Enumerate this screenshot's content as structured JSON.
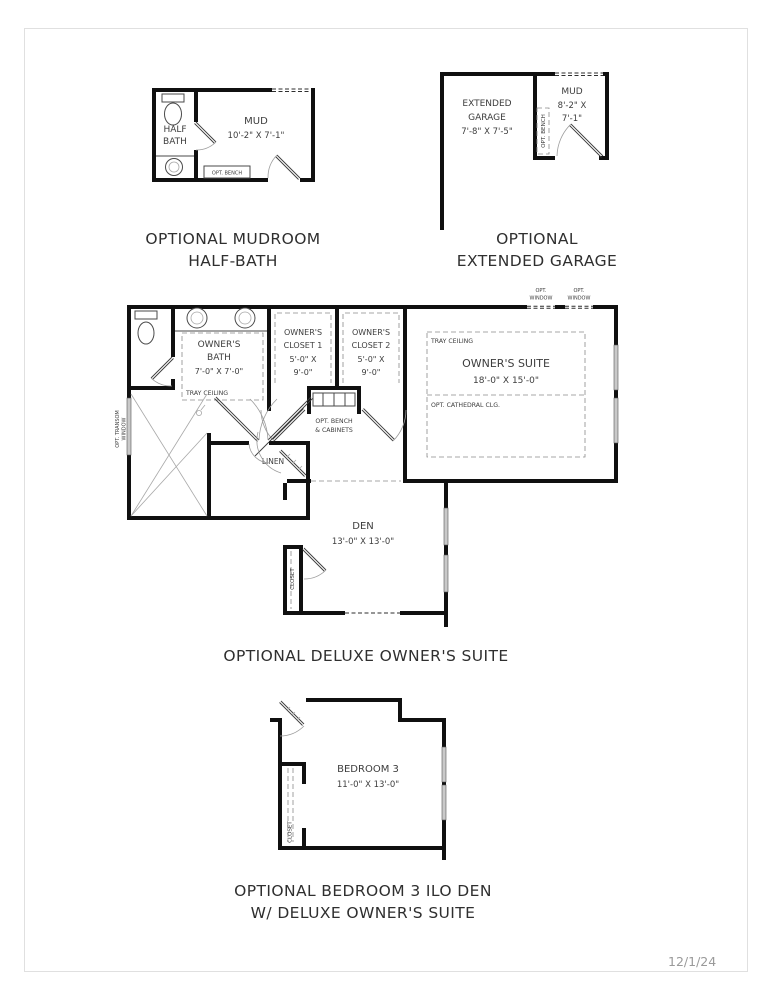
{
  "page": {
    "date": "12/1/24"
  },
  "mudroom_plan": {
    "caption_line1": "OPTIONAL MUDROOM",
    "caption_line2": "HALF-BATH",
    "half_bath_line1": "HALF",
    "half_bath_line2": "BATH",
    "mud_name": "MUD",
    "mud_dims": "10'-2\" X 7'-1\"",
    "bench_label": "OPT. BENCH"
  },
  "garage_plan": {
    "caption_line1": "OPTIONAL",
    "caption_line2": "EXTENDED GARAGE",
    "garage_line1": "EXTENDED",
    "garage_line2": "GARAGE",
    "garage_dims": "7'-8\" X 7'-5\"",
    "mud_name": "MUD",
    "mud_dims_line1": "8'-2\" X",
    "mud_dims_line2": "7'-1\"",
    "bench_label": "OPT. BENCH"
  },
  "suite_plan": {
    "caption": "OPTIONAL DELUXE OWNER'S SUITE",
    "opt_window_line1": "OPT.",
    "opt_window_line2": "WINDOW",
    "bath_line1": "OWNER'S",
    "bath_line2": "BATH",
    "bath_dims": "7'-0\" X 7'-0\"",
    "bath_ceiling": "TRAY CEILING",
    "closet1_line1": "OWNER'S",
    "closet1_line2": "CLOSET 1",
    "closet1_dims_line1": "5'-0\" X",
    "closet1_dims_line2": "9'-0\"",
    "closet2_line1": "OWNER'S",
    "closet2_line2": "CLOSET 2",
    "closet2_dims_line1": "5'-0\" X",
    "closet2_dims_line2": "9'-0\"",
    "bench_line1": "OPT. BENCH",
    "bench_line2": "& CABINETS",
    "suite_ceiling": "TRAY CEILING",
    "suite_name": "OWNER'S SUITE",
    "suite_dims": "18'-0\" X 15'-0\"",
    "suite_opt_ceiling": "OPT. CATHEDRAL CLG.",
    "transom_line1": "OPT. TRANSOM",
    "transom_line2": "WINDOW",
    "linen": "LINEN",
    "den_name": "DEN",
    "den_dims": "13'-0\" X 13'-0\"",
    "den_closet": "CLOSET"
  },
  "bedroom_plan": {
    "caption_line1": "OPTIONAL BEDROOM 3 ILO DEN",
    "caption_line2": "W/ DELUXE OWNER'S SUITE",
    "name": "BEDROOM 3",
    "dims": "11'-0\" X 13'-0\"",
    "closet": "CLOSET"
  }
}
